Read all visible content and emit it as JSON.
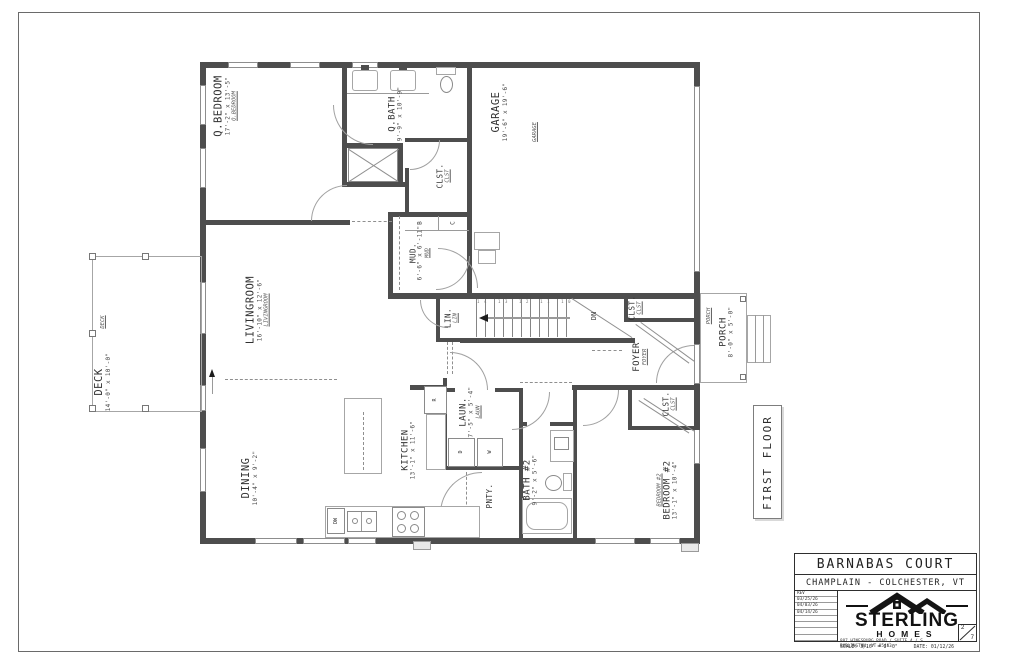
{
  "sheet": {
    "title": "FIRST FLOOR"
  },
  "title_block": {
    "project": "BARNABAS COURT",
    "location": "CHAMPLAIN - COLCHESTER, VT",
    "rev_label": "REV",
    "revisions": [
      "03/25/26",
      "04/03/26",
      "04/14/26"
    ],
    "company_top": "STERLING",
    "company_bottom": "HOMES",
    "address": "807 HINESBURG ROAD / SUITE 4 / S. BURLINGTON, VT 05403",
    "scale": "SCALE: 3/16\" = 1'-0\"",
    "date": "DATE: 01/12/26",
    "sheet_number": "2",
    "sheet_total": "7"
  },
  "rooms": {
    "qbedroom": {
      "name": "Q.BEDROOM",
      "dims": "17'-2\" x 13'-5\"",
      "tag": "Q.BEDROOM"
    },
    "qbath": {
      "name": "Q.BATH",
      "dims": "9'-9\" x 10'-9\""
    },
    "clst1": {
      "name": "CLST.",
      "tag": "CLST"
    },
    "mud": {
      "name": "MUD.",
      "dims": "6'-6\" x 6'-11\"",
      "tag": "MUD"
    },
    "garage": {
      "name": "GARAGE",
      "dims": "19'-6\" x 19'-6\"",
      "tag": "GARAGE"
    },
    "livingroom": {
      "name": "LIVINGROOM",
      "dims": "16'-10\" x 12'-6\"",
      "tag": "LIVINGROOM"
    },
    "deck": {
      "name": "DECK",
      "dims": "14'-0\" x 10'-0\"",
      "tag": "DECK"
    },
    "lin": {
      "name": "LIN.",
      "tag": "LIN"
    },
    "foyer": {
      "name": "FOYER",
      "tag": "FOYER"
    },
    "clst2": {
      "name": "CLST.",
      "tag": "CLST"
    },
    "porch": {
      "name": "PORCH",
      "dims": "8'-0\" x 5'-0\"",
      "tag": "PORCH"
    },
    "dining": {
      "name": "DINING",
      "dims": "10'-4\" x 9'-2\""
    },
    "kitchen": {
      "name": "KITCHEN",
      "dims": "13'-1\" x 11'-6\""
    },
    "laun": {
      "name": "LAUN.",
      "dims": "7'-5\" x 5'-4\"",
      "tag": "LAUN"
    },
    "pnty": {
      "name": "PNTY."
    },
    "bath2": {
      "name": "BATH #2",
      "dims": "9'-2\" x 5'-6\""
    },
    "bedroom2": {
      "name": "BEDROOM #2",
      "dims": "13'-1\" x 10'-4\"",
      "tag": "BEDROOM #2"
    },
    "clst3": {
      "name": "CLST.",
      "tag": "CLST"
    }
  },
  "stairs": {
    "dn_label": "DN",
    "tread_numbers": "14 13 12 11 10 9 8 7 6 5 4"
  },
  "mud_cubbies": {
    "b": "B",
    "c": "C"
  },
  "appliances": {
    "dishwasher": "DW",
    "fridge": "R",
    "dryer": "D",
    "washer": "W"
  },
  "colors": {
    "wall": "#4d4d4d",
    "line": "#9a9a9a",
    "text": "#2f2f2f"
  }
}
